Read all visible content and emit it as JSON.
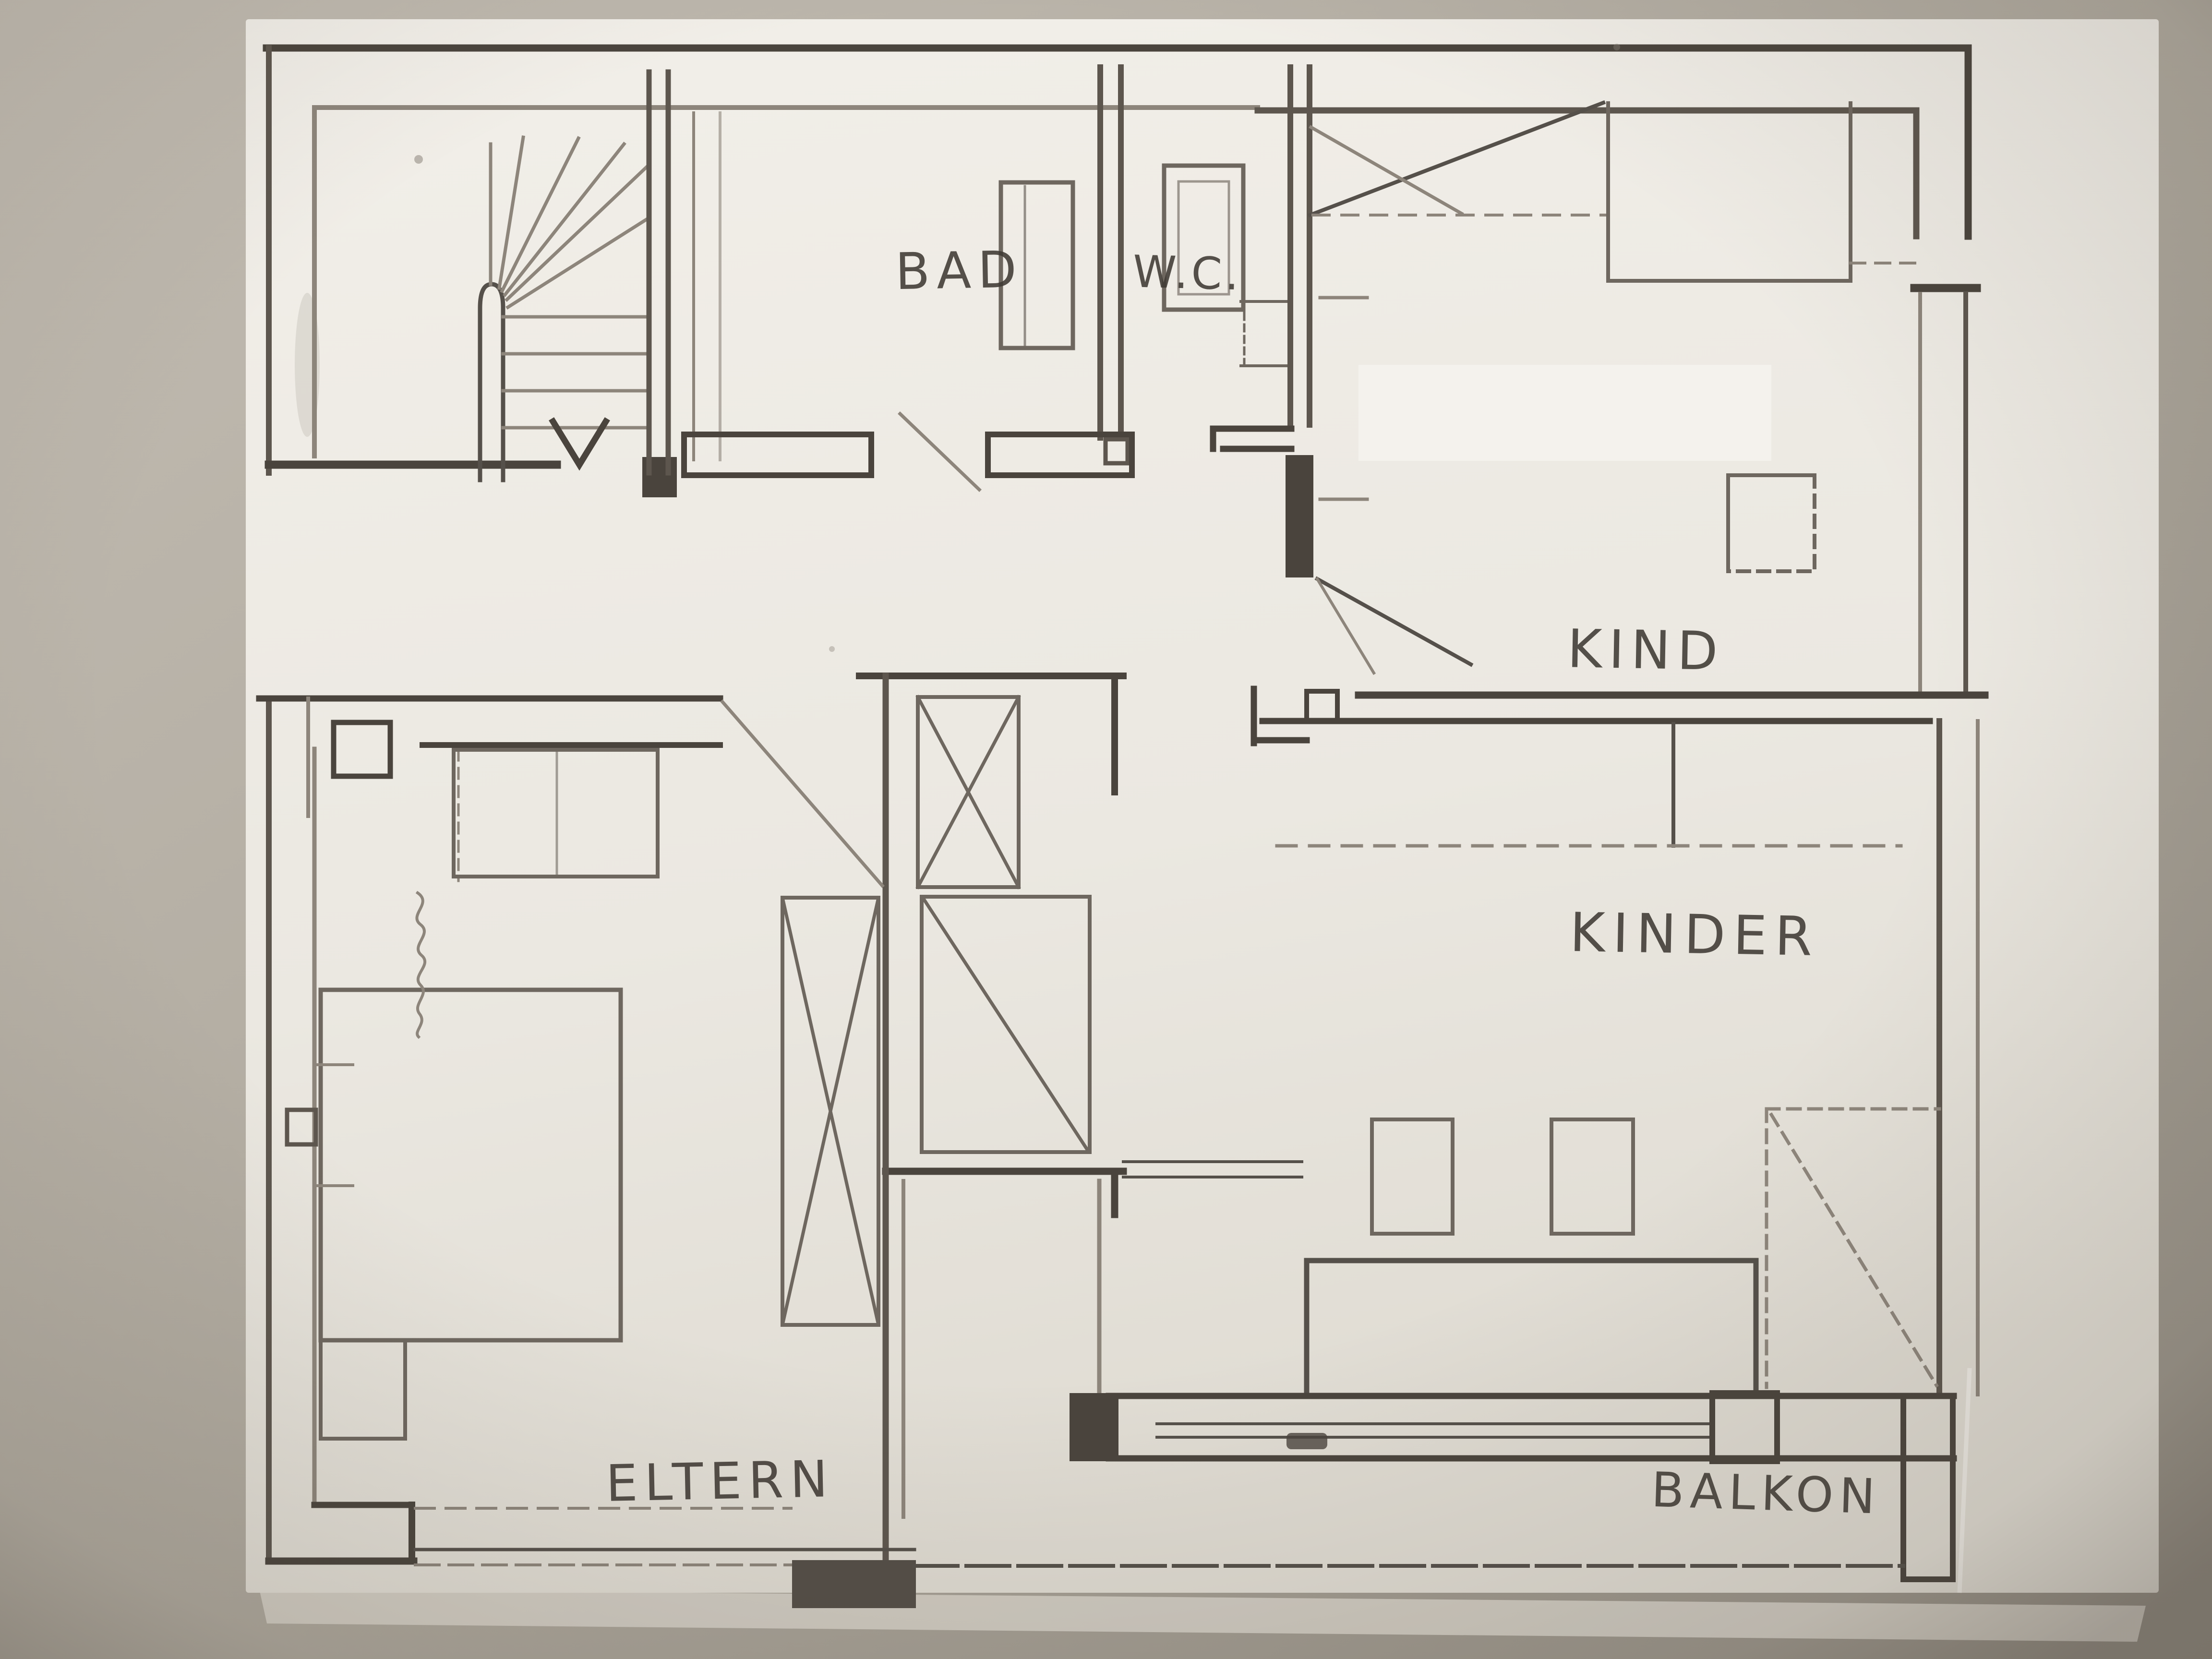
{
  "document": {
    "kind": "hand-drawn pencil floor plan, photographed on a table",
    "language": "German"
  },
  "rooms": [
    {
      "id": "bad",
      "label": "BAD"
    },
    {
      "id": "wc",
      "label": "W.C."
    },
    {
      "id": "kind",
      "label": "KIND"
    },
    {
      "id": "kinder",
      "label": "KINDER"
    },
    {
      "id": "eltern",
      "label": "ELTERN"
    },
    {
      "id": "balkon",
      "label": "BALKON"
    }
  ],
  "colors": {
    "background": "#b1ab9f",
    "paper": "#efece6",
    "pencil_dark": "#4a443d",
    "pencil_mid": "#5d564e",
    "pencil_light": "#8d857b",
    "label_ink": "#3f3a34"
  }
}
